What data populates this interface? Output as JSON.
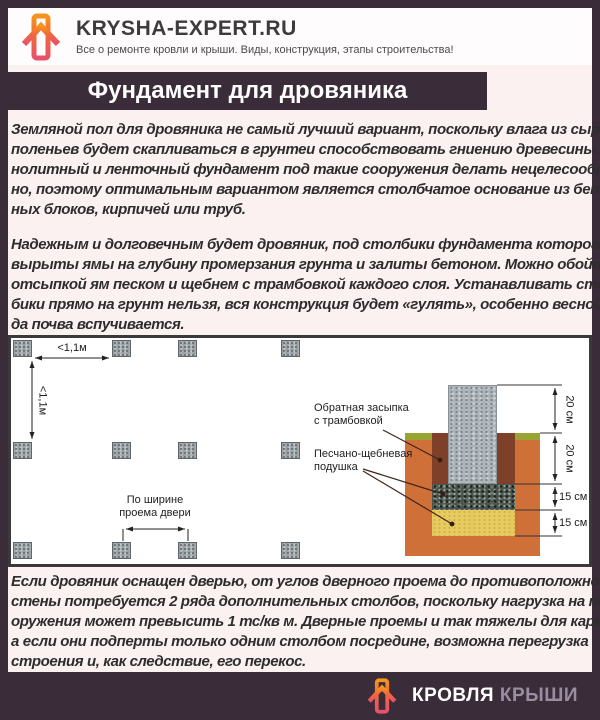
{
  "header": {
    "site_title": "KRYSHA-EXPERT.RU",
    "tagline": "Все о ремонте кровли и крыши. Виды, конструкция, этапы строительства!"
  },
  "title_bar": {
    "title": "Фундамент для дровяника"
  },
  "paragraphs": {
    "p1": {
      "lines": [
        "Земляной пол для дровяника не самый лучший вариант, поскольку влага из сырых",
        "поленьев будет скапливаться в грунтеи способствовать гниению древесины. Мо-",
        "нолитный и ленточный фундамент под такие сооружения делать нецелесообраз-",
        "но, поэтому оптимальным вариантом является столбчатое основание из бетон-",
        "ных блоков, кирпичей или труб."
      ]
    },
    "p2": {
      "lines": [
        "Надежным и долговечным будет дровяник, под столбики фундамента которого",
        "вырыты ямы на глубину промерзания грунта и залиты бетоном. Можно обойтись",
        "отсыпкой ям песком и щебнем с трамбовкой каждого слоя. Устанавливать стол-",
        "бики прямо на грунт нельзя, вся конструкция будет «гулять», особенно весной, ког-",
        "да почва вспучивается."
      ]
    },
    "p3": {
      "lines": [
        "Если дровяник оснащен дверью, от углов дверного проема до противоположной",
        "стены потребуется 2 ряда дополнительных столбов, поскольку нагрузка на пол со-",
        "оружения может превысить 1 тс/кв м. Дверные проемы и так тяжелы для каркаса,",
        "а если они подперты только одним столбом посредине, возможна перегрузка",
        "строения и, как следствие, его перекос."
      ]
    }
  },
  "diagram": {
    "plan": {
      "dim_horizontal": "<1,1м",
      "dim_vertical": "<1,1м",
      "door_label_line1": "По ширине",
      "door_label_line2": "проема двери"
    },
    "section": {
      "label_backfill_line1": "Обратная засыпка",
      "label_backfill_line2": "с трамбовкой",
      "label_cushion_line1": "Песчано-щебневая",
      "label_cushion_line2": "подушка",
      "dims": [
        "20 см",
        "20 см",
        "15 см",
        "15 см"
      ]
    }
  },
  "footer": {
    "brand_word1": "КРОВЛЯ",
    "brand_word2": "КРЫШИ"
  },
  "colors": {
    "frame": "#3a2c39",
    "body_bg": "#fbf1f1",
    "diagram_border": "#3a3a3a",
    "soil_orange": "#cf7038",
    "backfill_brown": "#7e4028",
    "grass_green": "#97a431",
    "sand_yellow": "#e7cb61",
    "concrete_gray": "#adb4ba",
    "gravel_dark": "#4a544c",
    "logo_orange": "#f7941d",
    "logo_pink": "#e8506b",
    "brand_gray": "#9a8da1"
  }
}
